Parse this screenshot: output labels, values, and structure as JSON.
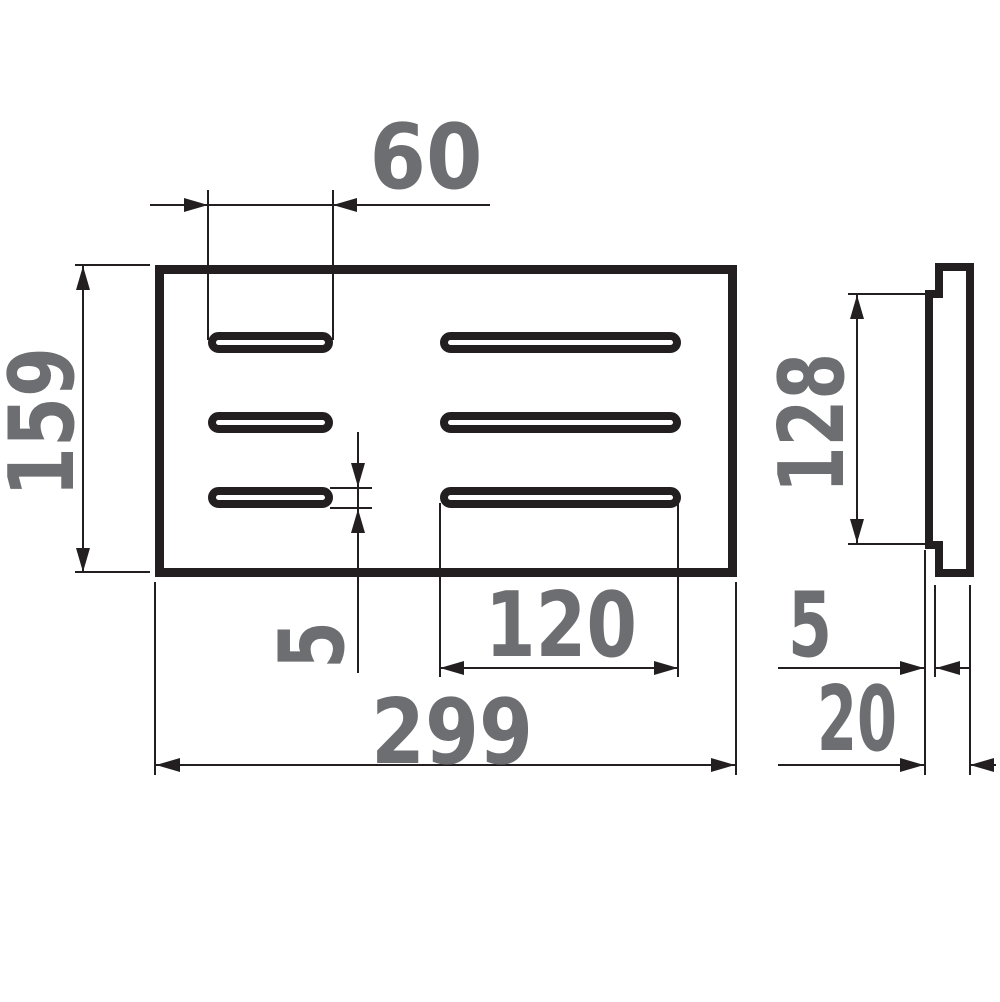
{
  "drawing": {
    "front_view": {
      "short_slot_width_mm": "60",
      "panel_height_mm": "159",
      "slot_height_mm": "5",
      "long_slot_width_mm": "120",
      "panel_width_mm": "299"
    },
    "side_view": {
      "recessed_face_height_mm": "128",
      "lip_depth_mm": "5",
      "total_depth_mm": "20"
    },
    "colors": {
      "line": "#231f20",
      "label": "#6d6e71",
      "background": "#ffffff"
    }
  }
}
